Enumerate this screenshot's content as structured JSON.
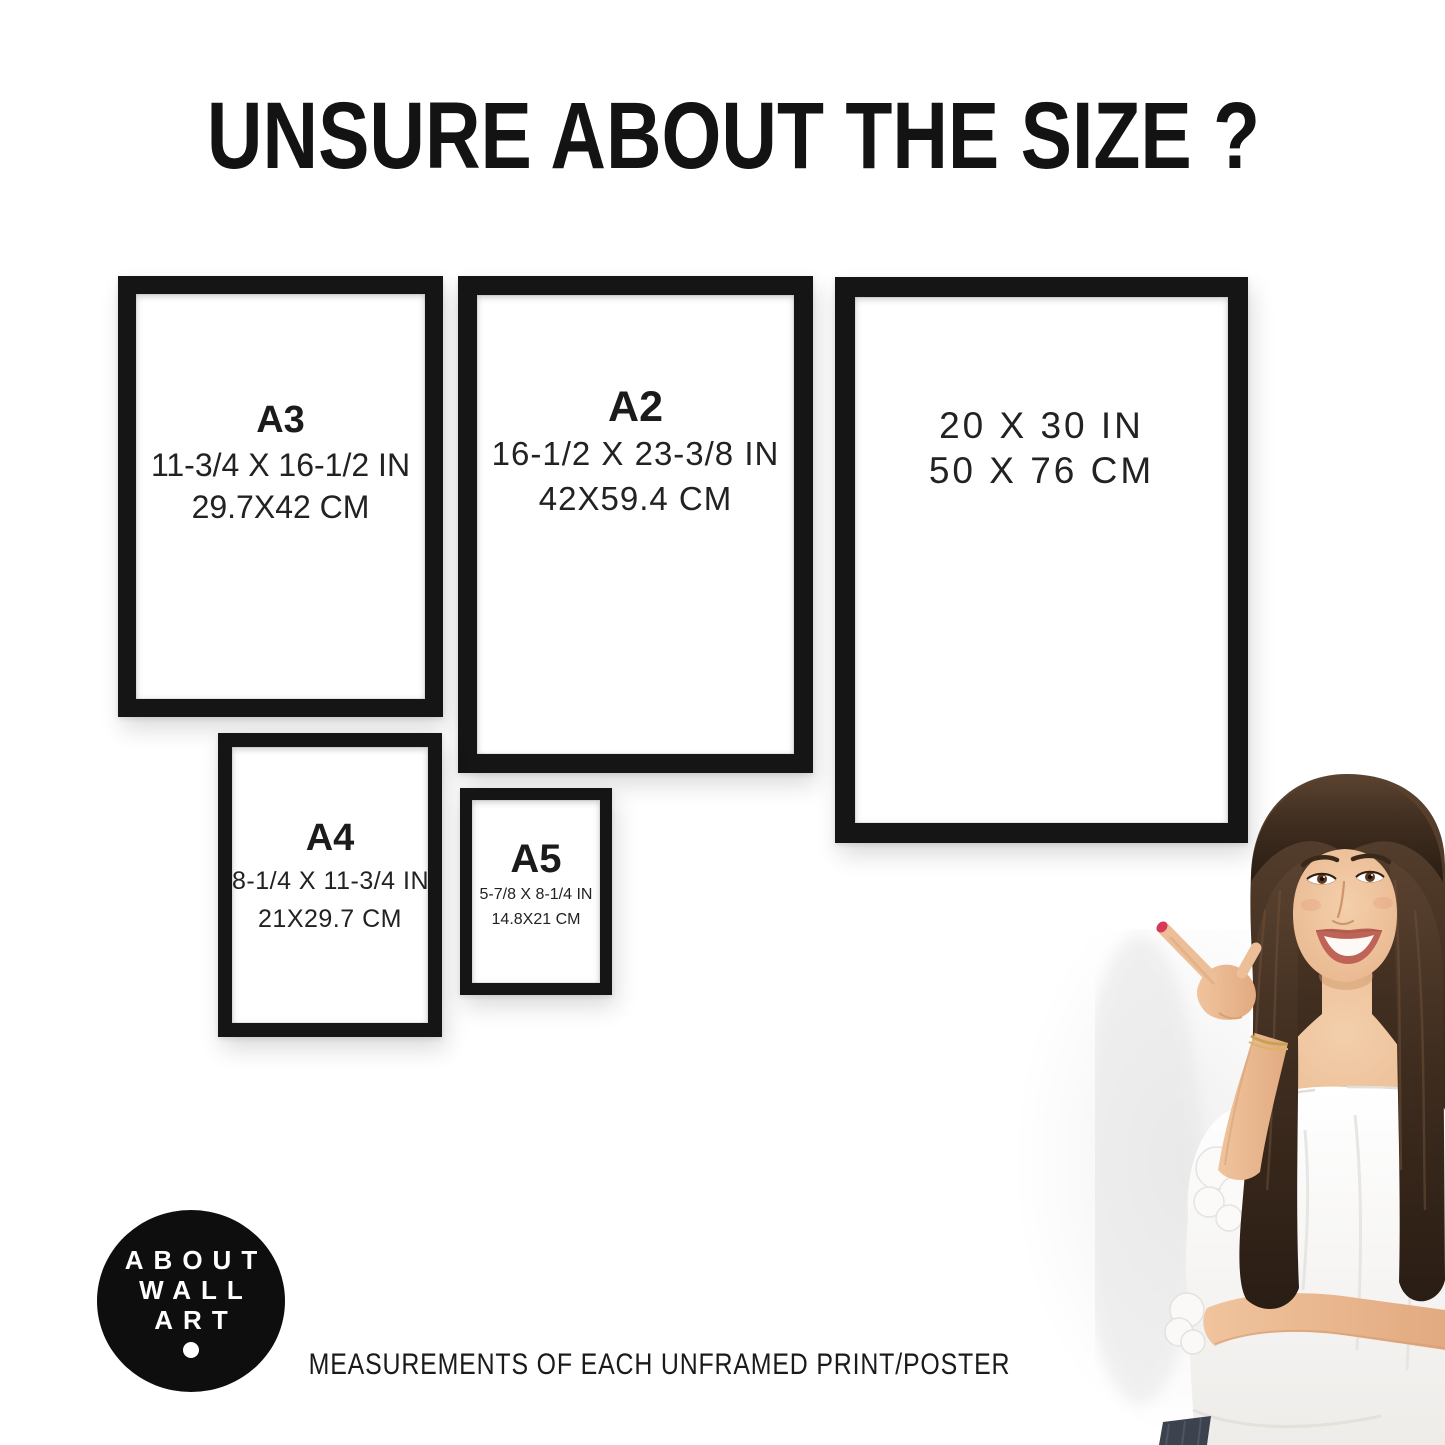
{
  "title": "UNSURE ABOUT THE SIZE ?",
  "caption": "MEASUREMENTS OF EACH UNFRAMED PRINT/POSTER",
  "logo": {
    "lines": [
      "ABOUT",
      "WALL",
      "ART"
    ]
  },
  "frames": [
    {
      "name": "A3",
      "label": "A3",
      "size_in": "11-3/4 X 16-1/2 IN",
      "size_cm": "29.7X42 CM"
    },
    {
      "name": "A2",
      "label": "A2",
      "size_in": "16-1/2 X 23-3/8 IN",
      "size_cm": "42X59.4 CM"
    },
    {
      "name": "20x30",
      "label": "",
      "size_in": "20 X 30 IN",
      "size_cm": "50 X 76 CM"
    },
    {
      "name": "A4",
      "label": "A4",
      "size_in": "8-1/4 X 11-3/4 IN",
      "size_cm": "21X29.7 CM"
    },
    {
      "name": "A5",
      "label": "A5",
      "size_in": "5-7/8 X 8-1/4 IN",
      "size_cm": "14.8X21 CM"
    }
  ],
  "colors": {
    "background": "#ffffff",
    "frame": "#151515",
    "text": "#161616",
    "logo_bg": "#0e0e0e",
    "logo_text": "#ffffff",
    "nail_polish": "#d63a57",
    "hair": "#3f2d1f",
    "skin": "#ecbf99",
    "blouse": "#f6f5f3",
    "jeans": "#3c434e"
  }
}
